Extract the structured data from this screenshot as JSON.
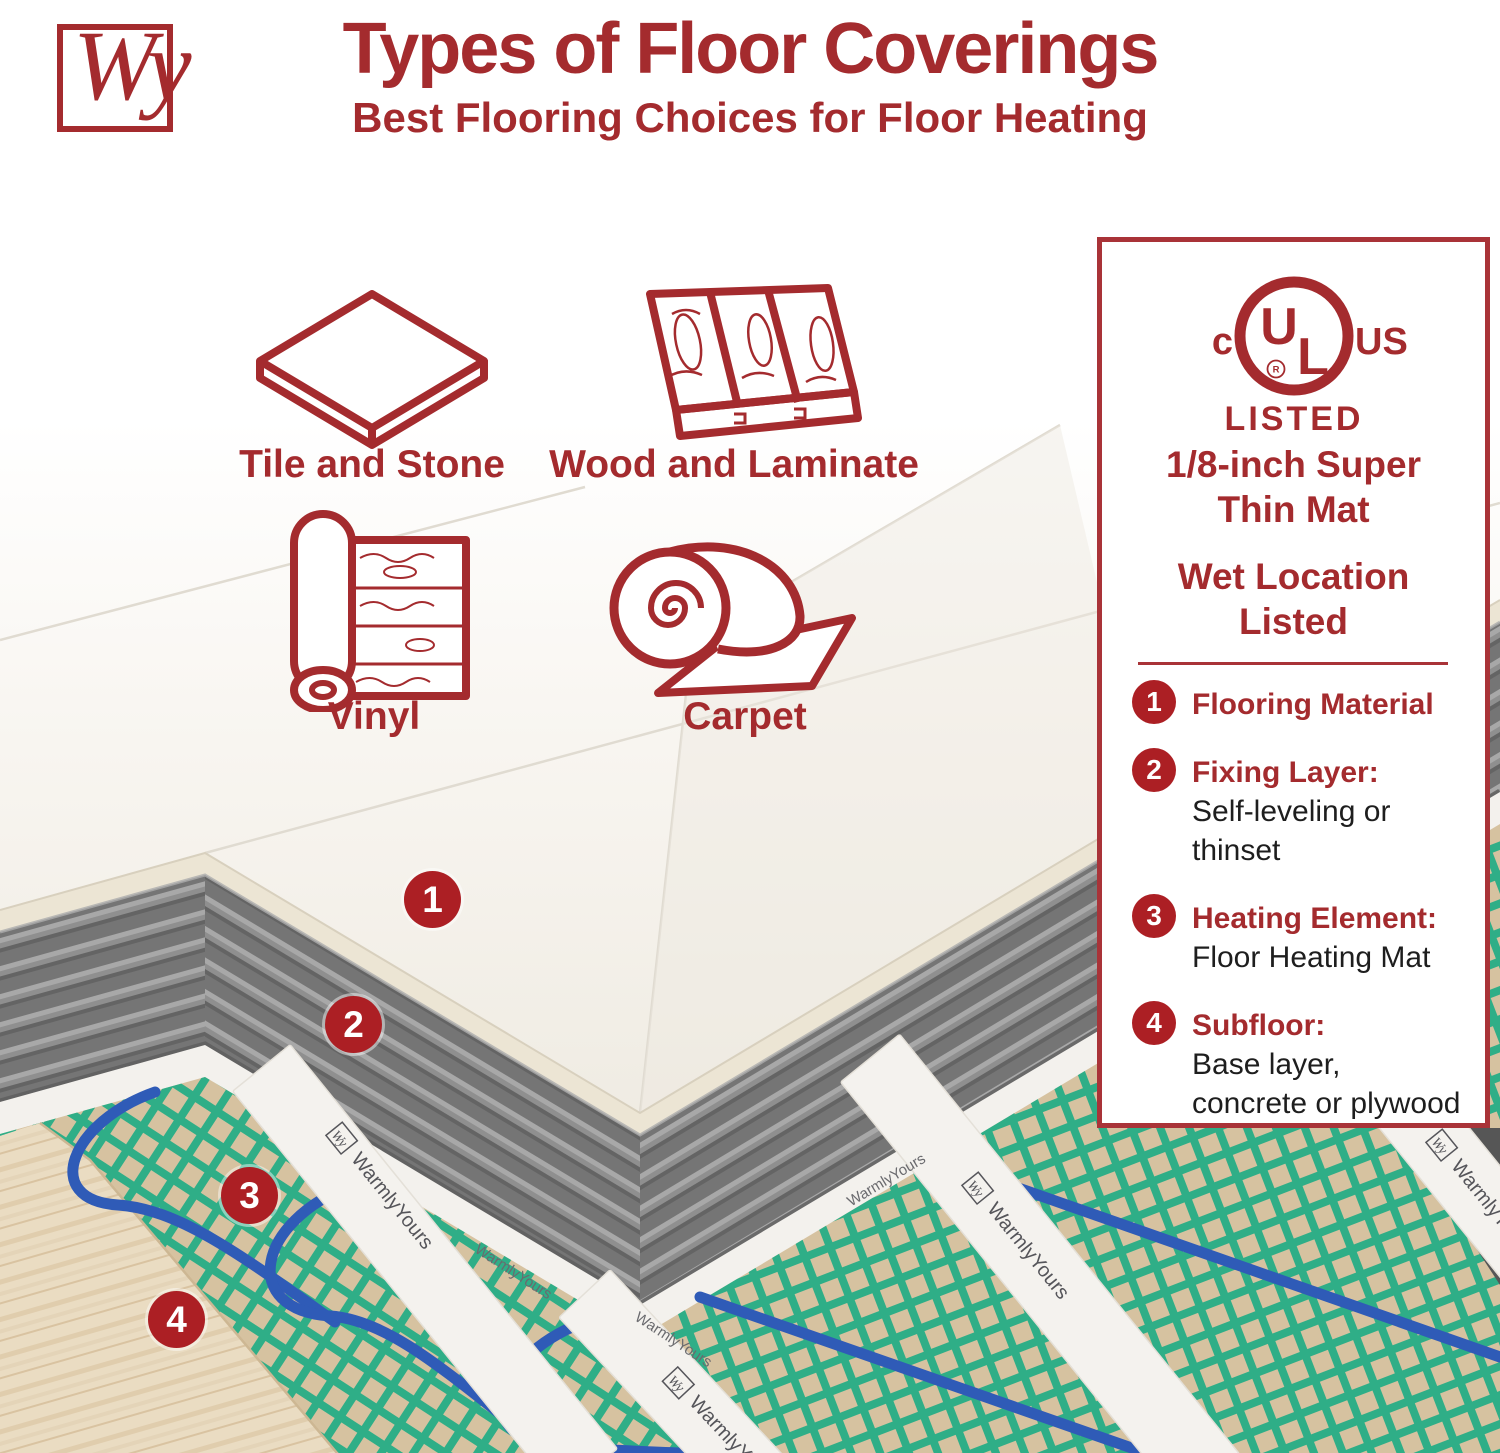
{
  "brand": {
    "logo_text": "Wy"
  },
  "header": {
    "title": "Types of Floor Coverings",
    "subtitle": "Best Flooring Choices for Floor Heating"
  },
  "flooring_types": [
    {
      "label": "Tile and Stone"
    },
    {
      "label": "Wood and Laminate"
    },
    {
      "label": "Vinyl"
    },
    {
      "label": "Carpet"
    }
  ],
  "panel": {
    "ul": {
      "c": "c",
      "center_u": "U",
      "center_l": "L",
      "reg": "R",
      "us": "US",
      "listed": "LISTED"
    },
    "feature1": "1/8-inch Super\nThin Mat",
    "feature2": "Wet Location\nListed",
    "items": [
      {
        "num": "1",
        "title": "Flooring Material",
        "desc": ""
      },
      {
        "num": "2",
        "title": "Fixing Layer:",
        "desc": "Self-leveling or thinset"
      },
      {
        "num": "3",
        "title": "Heating Element:",
        "desc": "Floor Heating Mat"
      },
      {
        "num": "4",
        "title": "Subfloor:",
        "desc": "Base layer, concrete or plywood"
      }
    ]
  },
  "diagram": {
    "mat_brand": "WarmlyYours",
    "mat_logo": "Wy"
  },
  "colors": {
    "brand_red": "#A42B2E",
    "badge_red": "#AC1F24",
    "border_red": "#A93338",
    "mesh_green": "#2FAE87",
    "wire_blue": "#2F5BB7",
    "mat_tan": "#D6C2A0",
    "wood": "#EADCC2",
    "thinset_gray": "#8F8F8F"
  }
}
